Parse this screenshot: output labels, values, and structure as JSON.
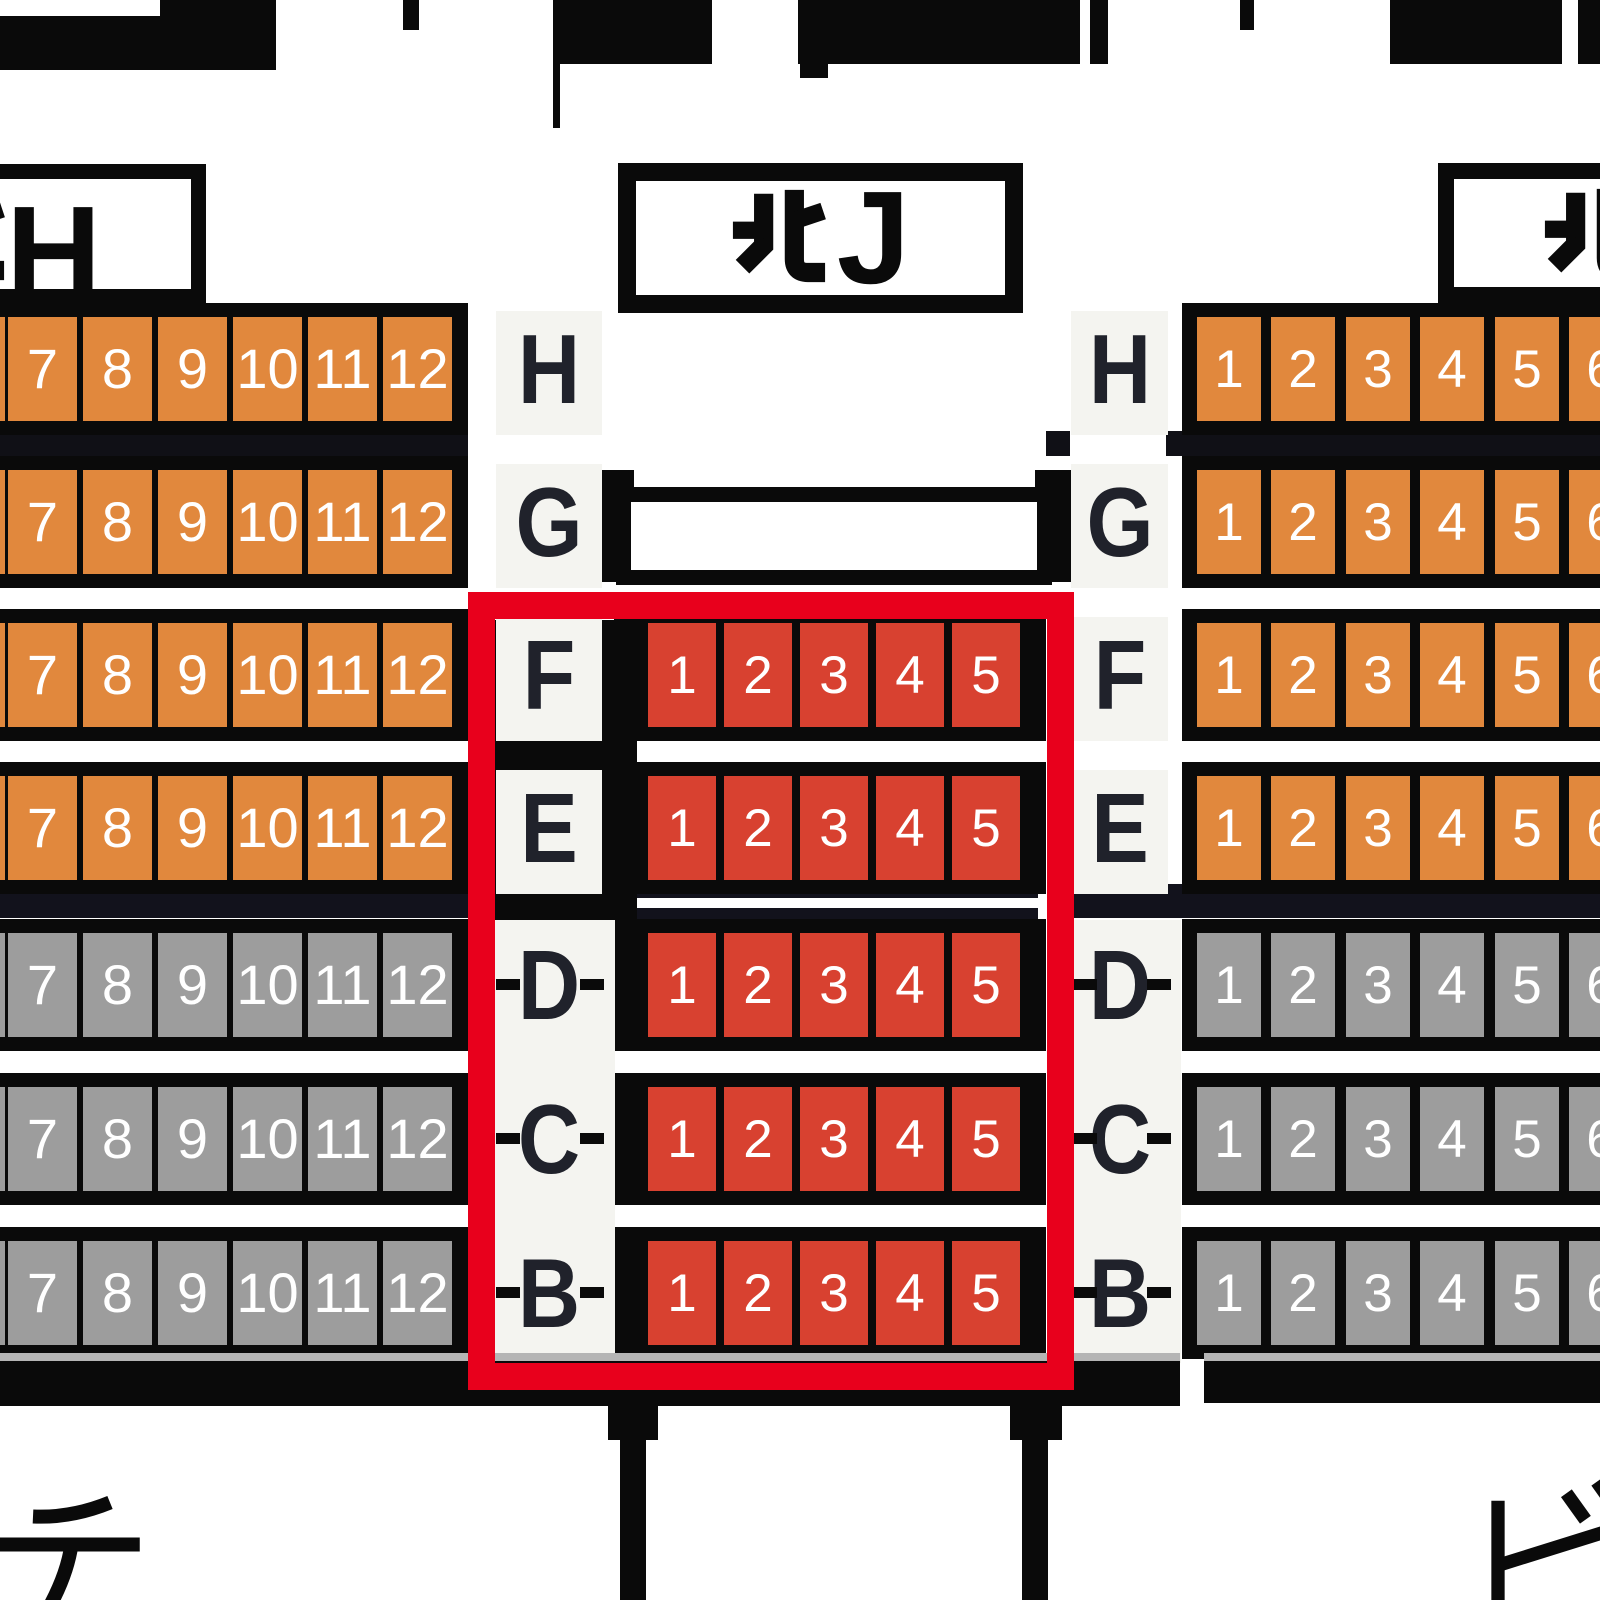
{
  "section_boxes": {
    "left": {
      "label": "北H",
      "latin": "H"
    },
    "center": {
      "label": "北J",
      "latin": "J"
    },
    "right": {
      "label": "北",
      "latin": ""
    }
  },
  "rows": [
    {
      "letter": "H",
      "side_zone": "orange",
      "center_seats": false,
      "ticks": false
    },
    {
      "letter": "G",
      "side_zone": "orange",
      "center_seats": false,
      "ticks": false
    },
    {
      "letter": "F",
      "side_zone": "orange",
      "center_seats": true,
      "ticks": false
    },
    {
      "letter": "E",
      "side_zone": "orange",
      "center_seats": true,
      "ticks": false
    },
    {
      "letter": "D",
      "side_zone": "gray",
      "center_seats": true,
      "ticks": true
    },
    {
      "letter": "C",
      "side_zone": "gray",
      "center_seats": true,
      "ticks": true
    },
    {
      "letter": "B",
      "side_zone": "gray",
      "center_seats": true,
      "ticks": true
    }
  ],
  "seat_numbers": {
    "left_block": [
      "7",
      "8",
      "9",
      "10",
      "11",
      "12"
    ],
    "center_block": [
      "1",
      "2",
      "3",
      "4",
      "5"
    ],
    "right_block": [
      "1",
      "2",
      "3",
      "4",
      "5",
      "6"
    ]
  },
  "bottom_labels": {
    "left": "チ",
    "right": "ビ"
  },
  "colors": {
    "orange_seat": "#e1883d",
    "gray_seat": "#9d9d9d",
    "red_seat": "#d84130",
    "highlight_red": "#e8001c",
    "frame_black": "#0a0a0a",
    "divider_navy": "#12121c",
    "divider_dark": "#101016",
    "plate_white": "#f4f4f0",
    "letter_dark": "#20222b",
    "seat_number_white": "#ffffff"
  }
}
